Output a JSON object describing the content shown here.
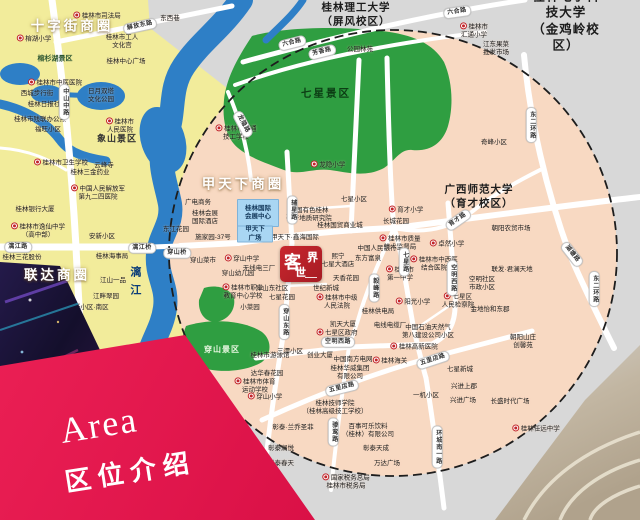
{
  "banner": {
    "title_en": "Area",
    "title_zh": "区位介绍"
  },
  "logo": {
    "name": "客世界",
    "char_main": "客",
    "char_top_right": "界",
    "char_bottom": "世"
  },
  "colors": {
    "banner_red": "#d60d43",
    "logo_red": "#b5202c",
    "map_yellow": "#f2ec9b",
    "map_pink": "#f8d9c2",
    "map_grey": "#d8d8d8",
    "park_green": "#2f9e41",
    "water_blue": "#2e7fc6",
    "landmark_blue": "#a9d6f3"
  },
  "map": {
    "business_circles": [
      {
        "t": "十字街商圈",
        "x": 72,
        "y": 27
      },
      {
        "t": "甲天下商圈",
        "x": 243,
        "y": 185
      },
      {
        "t": "联达商圈",
        "x": 57,
        "y": 276
      }
    ],
    "scenic_areas": [
      {
        "t": "七星景区",
        "x": 326,
        "y": 94,
        "s": "dark"
      },
      {
        "t": "穿山景区",
        "x": 222,
        "y": 350,
        "s": "light"
      },
      {
        "t": "象山景区",
        "x": 117,
        "y": 139,
        "s": "plain"
      },
      {
        "t": "榕杉湖景区",
        "x": 55,
        "y": 60,
        "s": "small"
      }
    ],
    "universities": [
      {
        "t": "桂林理工大学\n（屏风校区）",
        "x": 356,
        "y": 15
      },
      {
        "t": "广西师范大学\n（育才校区）",
        "x": 479,
        "y": 197
      },
      {
        "t": "桂林电子科技大学\n（金鸡岭校区）",
        "x": 566,
        "y": 21,
        "big": 1
      }
    ],
    "landmarks": [
      {
        "t": "桂林国际\n会展中心",
        "x": 258,
        "y": 213,
        "w": 40,
        "h": 26
      },
      {
        "t": "甲天下\n广场",
        "x": 255,
        "y": 234,
        "w": 34,
        "h": 15
      }
    ],
    "water_labels": [
      {
        "t": "漓江",
        "x": 134,
        "y": 284
      }
    ],
    "roads": [
      {
        "t": "解放东路",
        "x": 140,
        "y": 26,
        "r": -12
      },
      {
        "t": "中山中路",
        "x": 64,
        "y": 102,
        "v": 1
      },
      {
        "t": "漓江路",
        "x": 18,
        "y": 247
      },
      {
        "t": "漓江桥",
        "x": 142,
        "y": 248
      },
      {
        "t": "穿山桥",
        "x": 177,
        "y": 253
      },
      {
        "t": "辅星路",
        "x": 292,
        "y": 210,
        "v": 1
      },
      {
        "t": "穿山东路",
        "x": 284,
        "y": 322,
        "v": 1
      },
      {
        "t": "龙隐路",
        "x": 243,
        "y": 124,
        "r": 62
      },
      {
        "t": "六合路",
        "x": 292,
        "y": 43,
        "r": -14
      },
      {
        "t": "六合路",
        "x": 457,
        "y": 12,
        "r": -8
      },
      {
        "t": "芳香路",
        "x": 322,
        "y": 52,
        "r": -14
      },
      {
        "t": "育才路",
        "x": 458,
        "y": 220,
        "r": -35
      },
      {
        "t": "空明西路",
        "x": 338,
        "y": 342
      },
      {
        "t": "空明西路",
        "x": 452,
        "y": 278,
        "v": 1
      },
      {
        "t": "七星路",
        "x": 404,
        "y": 262,
        "v": 1
      },
      {
        "t": "毅峰路",
        "x": 374,
        "y": 288,
        "v": 1
      },
      {
        "t": "五里店路",
        "x": 342,
        "y": 388,
        "r": -14
      },
      {
        "t": "五里店路",
        "x": 433,
        "y": 360,
        "r": -18
      },
      {
        "t": "东二环路",
        "x": 531,
        "y": 125,
        "v": 1
      },
      {
        "t": "东二环路",
        "x": 594,
        "y": 289,
        "v": 1
      },
      {
        "t": "环城南一路",
        "x": 437,
        "y": 447,
        "v": 1
      },
      {
        "t": "骖鸾路",
        "x": 333,
        "y": 432,
        "v": 1
      },
      {
        "t": "湖塘路",
        "x": 572,
        "y": 254,
        "r": 52
      }
    ],
    "pois": [
      {
        "t": "桂林市司法局",
        "x": 97,
        "y": 16,
        "m": 1
      },
      {
        "t": "东西巷",
        "x": 170,
        "y": 19
      },
      {
        "t": "榕湖小学",
        "x": 34,
        "y": 39,
        "m": 1
      },
      {
        "t": "桂林市工人\n文化宫",
        "x": 122,
        "y": 42
      },
      {
        "t": "桂林中心广场",
        "x": 126,
        "y": 62
      },
      {
        "t": "桂林市中医医院",
        "x": 55,
        "y": 83,
        "m": 1
      },
      {
        "t": "西城步行街",
        "x": 37,
        "y": 94
      },
      {
        "t": "桂林日报社",
        "x": 44,
        "y": 105
      },
      {
        "t": "桂林市残联办公点",
        "x": 40,
        "y": 120
      },
      {
        "t": "福旺小区",
        "x": 48,
        "y": 130
      },
      {
        "t": "桂林市卫生学校",
        "x": 61,
        "y": 163,
        "m": 1
      },
      {
        "t": "日月双塔\n文化公园",
        "x": 101,
        "y": 96
      },
      {
        "t": "桂林市\n人民医院",
        "x": 120,
        "y": 126,
        "m": 1
      },
      {
        "t": "云峰寺",
        "x": 104,
        "y": 166
      },
      {
        "t": "桂林三金药业",
        "x": 90,
        "y": 173
      },
      {
        "t": "桂林银行大厦",
        "x": 35,
        "y": 210
      },
      {
        "t": "中国人民解放军\n第九二四医院",
        "x": 98,
        "y": 193,
        "m": 1
      },
      {
        "t": "桂林市逸仙中学\n（高中部）",
        "x": 38,
        "y": 231,
        "m": 1
      },
      {
        "t": "安新小区",
        "x": 102,
        "y": 237
      },
      {
        "t": "桂林海事局",
        "x": 112,
        "y": 257
      },
      {
        "t": "江山一品",
        "x": 113,
        "y": 281
      },
      {
        "t": "江畔翠园",
        "x": 106,
        "y": 297
      },
      {
        "t": "安新小区·南区",
        "x": 88,
        "y": 308
      },
      {
        "t": "桂林三花股份",
        "x": 22,
        "y": 258
      },
      {
        "t": "东江花园",
        "x": 176,
        "y": 230
      },
      {
        "t": "桂林市交通\n技工学校",
        "x": 236,
        "y": 133,
        "m": 1
      },
      {
        "t": "龙隐小学",
        "x": 328,
        "y": 165,
        "m": 1
      },
      {
        "t": "公园林苑",
        "x": 360,
        "y": 50
      },
      {
        "t": "桂林市\n汇通小学",
        "x": 474,
        "y": 31,
        "m": 1
      },
      {
        "t": "江东果菜\n批发市场",
        "x": 496,
        "y": 49
      },
      {
        "t": "奇峰小区",
        "x": 494,
        "y": 143
      },
      {
        "t": "广电商务",
        "x": 198,
        "y": 203
      },
      {
        "t": "桂林会展\n国际酒店",
        "x": 205,
        "y": 218
      },
      {
        "t": "施家园-37号",
        "x": 213,
        "y": 238
      },
      {
        "t": "中国有色桂林\n矿产地质研究院",
        "x": 309,
        "y": 215
      },
      {
        "t": "桂林国贸商业城",
        "x": 340,
        "y": 226
      },
      {
        "t": "甲天下·鑫海国际",
        "x": 295,
        "y": 238
      },
      {
        "t": "熙宁\n七星大酒店",
        "x": 338,
        "y": 261
      },
      {
        "t": "穿山菜市",
        "x": 203,
        "y": 261
      },
      {
        "t": "穿山中学",
        "x": 242,
        "y": 259,
        "m": 1
      },
      {
        "t": "穿山幼儿园",
        "x": 238,
        "y": 274
      },
      {
        "t": "无线电三厂",
        "x": 259,
        "y": 269
      },
      {
        "t": "穿山东社区",
        "x": 272,
        "y": 289
      },
      {
        "t": "七星花园",
        "x": 282,
        "y": 298
      },
      {
        "t": "小菜园",
        "x": 250,
        "y": 308
      },
      {
        "t": "桂林市职业\n教育中心学校",
        "x": 243,
        "y": 292,
        "m": 1
      },
      {
        "t": "天香花园",
        "x": 346,
        "y": 279
      },
      {
        "t": "世纪新城",
        "x": 326,
        "y": 289
      },
      {
        "t": "桂林市中级\n人民法院",
        "x": 337,
        "y": 302,
        "m": 1
      },
      {
        "t": "七星小区",
        "x": 354,
        "y": 200
      },
      {
        "t": "育才小学",
        "x": 406,
        "y": 210,
        "m": 1
      },
      {
        "t": "长城花园",
        "x": 396,
        "y": 222
      },
      {
        "t": "桂林市质量\n技术监督局",
        "x": 400,
        "y": 243,
        "m": 1
      },
      {
        "t": "卓然小学",
        "x": 447,
        "y": 244,
        "m": 1
      },
      {
        "t": "桂林市中西医\n结合医院",
        "x": 434,
        "y": 264,
        "m": 1
      },
      {
        "t": "桂林市\n第一中学",
        "x": 400,
        "y": 274,
        "m": 1
      },
      {
        "t": "中国人民银行",
        "x": 377,
        "y": 249
      },
      {
        "t": "东方富泉",
        "x": 368,
        "y": 259
      },
      {
        "t": "朝阳农贸市场",
        "x": 511,
        "y": 229
      },
      {
        "t": "联发·君澜天地",
        "x": 512,
        "y": 270
      },
      {
        "t": "空明社区\n市政小区",
        "x": 482,
        "y": 284
      },
      {
        "t": "七星区\n人民检察院",
        "x": 458,
        "y": 301,
        "m": 1
      },
      {
        "t": "金地怡和东郡",
        "x": 490,
        "y": 310
      },
      {
        "t": "阳光小学",
        "x": 413,
        "y": 302,
        "m": 1
      },
      {
        "t": "桂林供电局",
        "x": 378,
        "y": 312
      },
      {
        "t": "电线电缆厂",
        "x": 390,
        "y": 326
      },
      {
        "t": "凯天大厦",
        "x": 343,
        "y": 325
      },
      {
        "t": "中国石油天然气\n第八建设公司小区",
        "x": 428,
        "y": 332
      },
      {
        "t": "七星区政府",
        "x": 337,
        "y": 333,
        "m": 1
      },
      {
        "t": "三潭小区",
        "x": 290,
        "y": 352
      },
      {
        "t": "创业大厦",
        "x": 320,
        "y": 356
      },
      {
        "t": "中国南方电网",
        "x": 353,
        "y": 360
      },
      {
        "t": "桂林华威集团\n有限公司",
        "x": 350,
        "y": 373
      },
      {
        "t": "桂林海关",
        "x": 390,
        "y": 361,
        "m": 1
      },
      {
        "t": "桂林市游泳馆",
        "x": 270,
        "y": 356
      },
      {
        "t": "达华春花园",
        "x": 267,
        "y": 374
      },
      {
        "t": "桂林市体育\n运动学校",
        "x": 255,
        "y": 386,
        "m": 1
      },
      {
        "t": "穿山小学",
        "x": 265,
        "y": 397,
        "m": 1
      },
      {
        "t": "桂林技师学院\n（桂林高级技工学校）",
        "x": 335,
        "y": 408
      },
      {
        "t": "彰泰·兰乔圣菲",
        "x": 293,
        "y": 428
      },
      {
        "t": "百事可乐饮料\n（桂林）有限公司",
        "x": 368,
        "y": 431
      },
      {
        "t": "彰泰澜悦",
        "x": 281,
        "y": 449
      },
      {
        "t": "彰泰春天",
        "x": 281,
        "y": 464
      },
      {
        "t": "彰泰天成",
        "x": 376,
        "y": 449
      },
      {
        "t": "万达广场",
        "x": 387,
        "y": 464
      },
      {
        "t": "国家税务总局\n桂林市税务局",
        "x": 346,
        "y": 482,
        "m": 1
      },
      {
        "t": "桂林高新医院",
        "x": 414,
        "y": 347,
        "m": 1
      },
      {
        "t": "七星新城",
        "x": 460,
        "y": 370
      },
      {
        "t": "兴进上郡",
        "x": 464,
        "y": 387
      },
      {
        "t": "兴进广场",
        "x": 463,
        "y": 401
      },
      {
        "t": "一机小区",
        "x": 426,
        "y": 396
      },
      {
        "t": "长盛时代广场",
        "x": 510,
        "y": 402
      },
      {
        "t": "朝阳山庄\n创馨苑",
        "x": 523,
        "y": 342
      },
      {
        "t": "桂林任远中学",
        "x": 536,
        "y": 429,
        "m": 1
      }
    ]
  }
}
